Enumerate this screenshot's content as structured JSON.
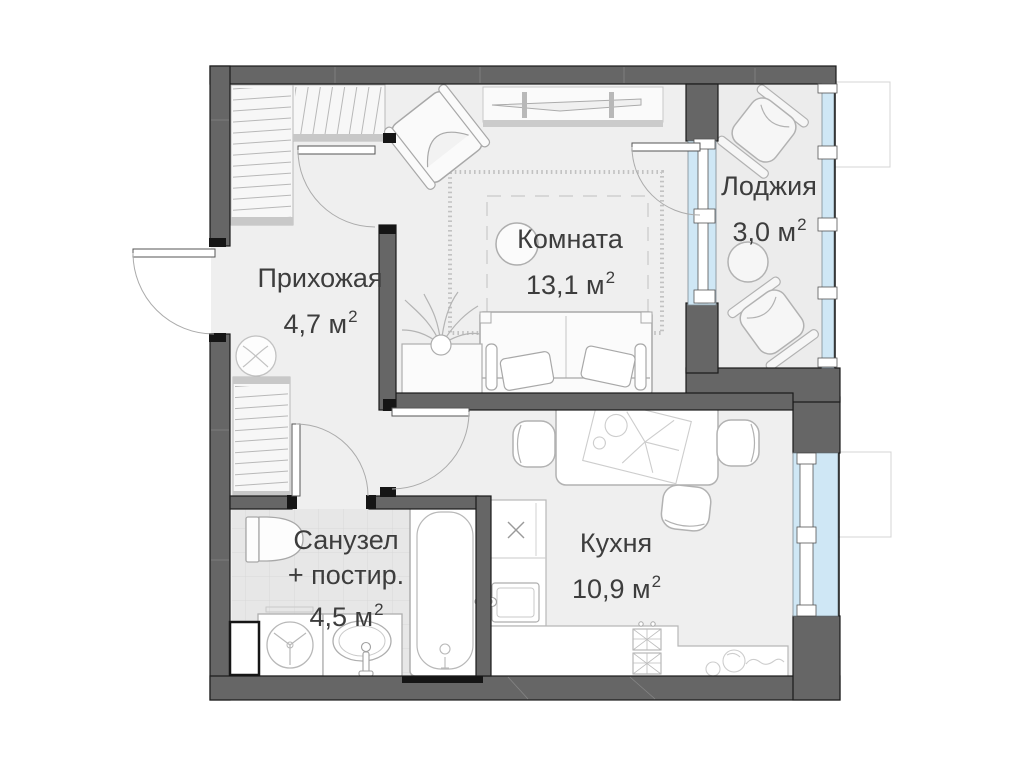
{
  "plan": {
    "type": "apartment-floor-plan",
    "rooms": {
      "hallway": {
        "name": "Прихожая",
        "area": "4,7 м",
        "sup": "2"
      },
      "room": {
        "name": "Комната",
        "area": "13,1 м",
        "sup": "2"
      },
      "loggia": {
        "name": "Лоджия",
        "area": "3,0 м",
        "sup": "2"
      },
      "bathroom": {
        "name": "Санузел",
        "name2": "+ постир.",
        "area": "4,5 м",
        "sup": "2"
      },
      "kitchen": {
        "name": "Кухня",
        "area": "10,9 м",
        "sup": "2"
      }
    },
    "colors": {
      "wall": "#666666",
      "wall_edge": "#1b1b1b",
      "floor": "#efefef",
      "loggia_floor": "#ececec",
      "bathroom_tile": "#e7e7e7",
      "window_glass": "#cfe7f5",
      "furniture_line": "#adadad",
      "label_text": "#3d3d3d"
    }
  }
}
